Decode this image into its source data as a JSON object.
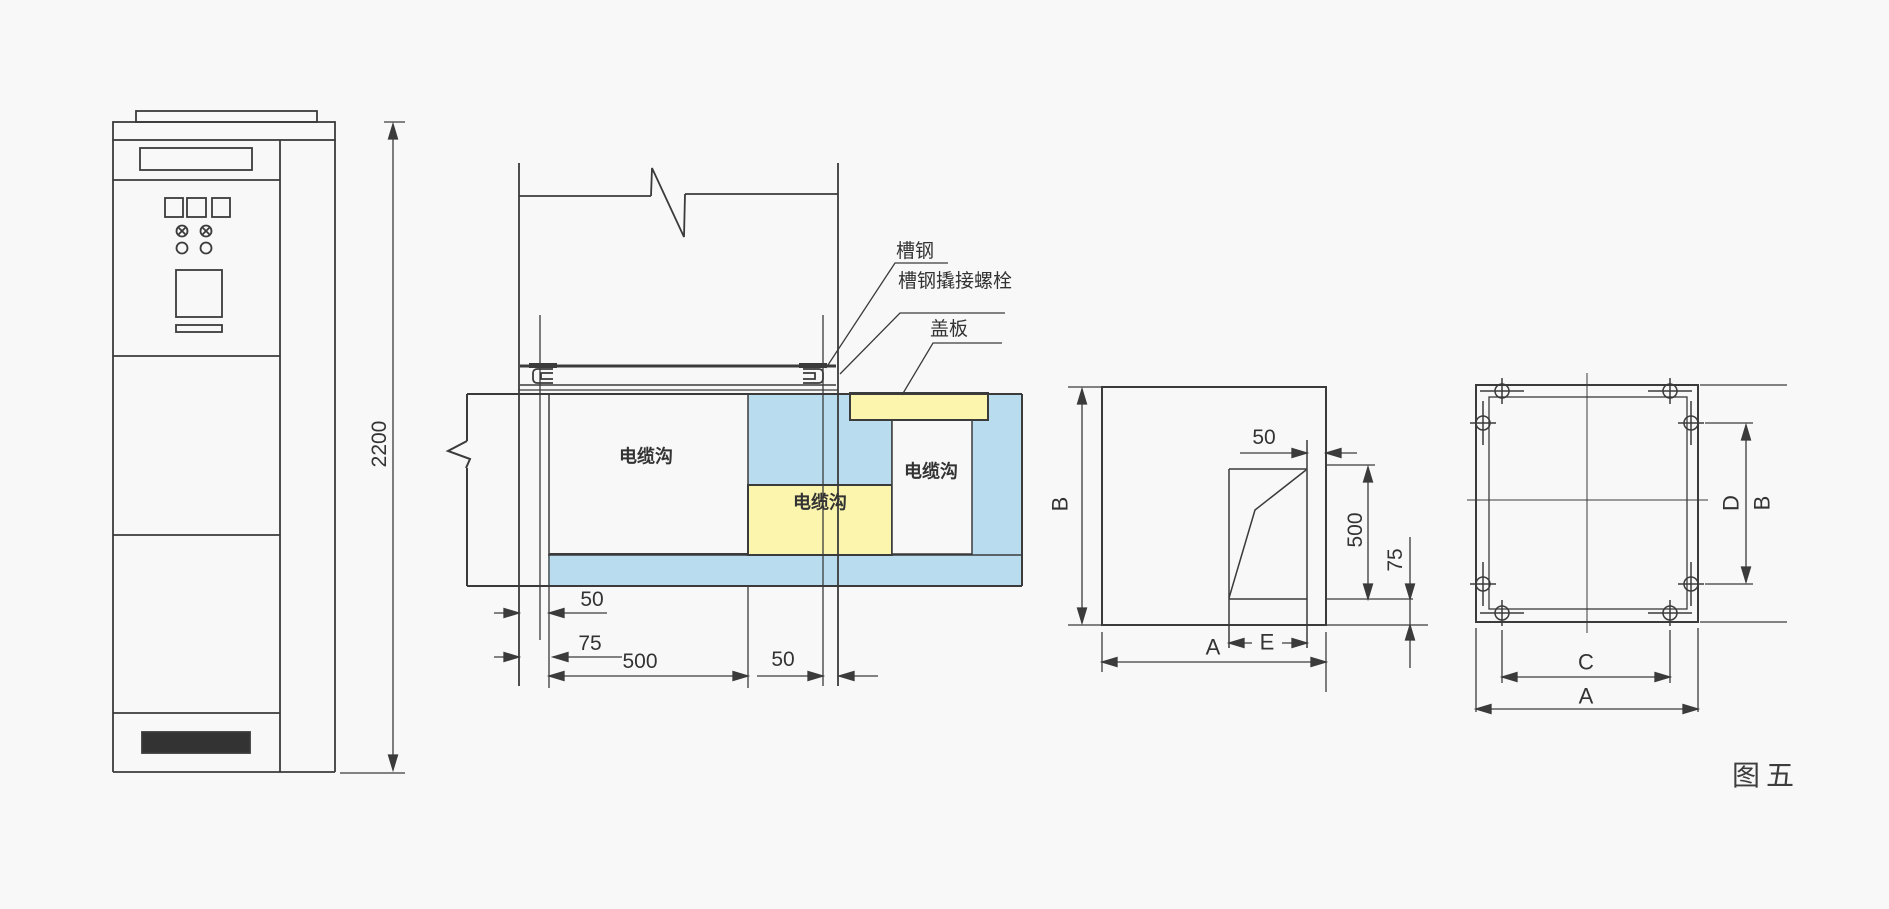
{
  "figure_label": "图五",
  "colors": {
    "line": "#3b3b3b",
    "trench_blue": "#b9ddee",
    "trench_yellow": "#fcf5ad",
    "background": "#f7f8f7"
  },
  "front_view": {
    "dim_height": "2200"
  },
  "section_view": {
    "label_channel_steel": "槽钢",
    "label_channel_bolt": "槽钢撬接螺栓",
    "label_cover_plate": "盖板",
    "label_trench_left": "电缆沟",
    "label_trench_mid": "电缆沟",
    "label_trench_right": "电缆沟",
    "dim_50_left": "50",
    "dim_75": "75",
    "dim_500": "500",
    "dim_50_right": "50"
  },
  "side_view": {
    "dim_b": "B",
    "dim_50": "50",
    "dim_500": "500",
    "dim_75": "75",
    "dim_a": "A",
    "dim_e": "E"
  },
  "plan_view": {
    "dim_d": "D",
    "dim_b": "B",
    "dim_c": "C",
    "dim_a": "A"
  }
}
